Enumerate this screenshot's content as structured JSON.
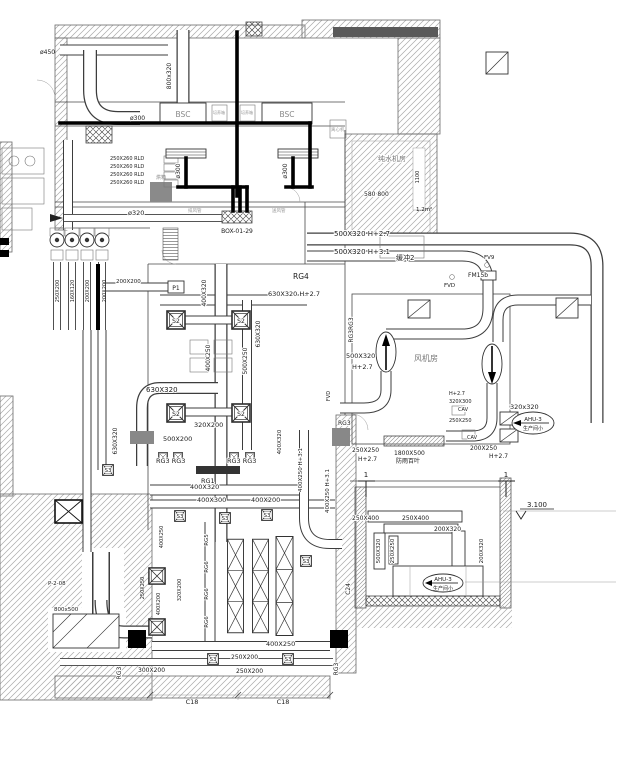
{
  "colors": {
    "background": "#ffffff",
    "line": "#3d3d3d",
    "pipe": "#000000",
    "hatch": "#a8a8a8"
  },
  "sizes": {
    "s450": "ø450",
    "s800x320": "800x320",
    "s300": "ø300",
    "s320": "ø320",
    "s250x260": "250X260 RLD",
    "s500x320h27": "500X320 H+2.7",
    "s500x320h31": "500X320 H+3.1",
    "s630x320h27": "630X320 H+2.7",
    "s630x320": "630X320",
    "s500x320": "500X320",
    "s500x250": "500X250",
    "s400x320": "400X320",
    "s400x250": "400X250",
    "s400x250h31": "400X250 H+3.1",
    "s320x200": "320X200",
    "s500x200": "500X200",
    "s400x300": "400X300",
    "s400x200": "400X200",
    "s300x200": "300X200",
    "s250x250": "250X250",
    "s250x200": "250X200",
    "s160x120": "160X120",
    "s200x200": "200X200",
    "s200x250": "200X250",
    "s320x300": "320X300",
    "s320x320": "320x320",
    "s250x400": "250X400",
    "s200x320": "200X320",
    "s1800x500": "1800X500",
    "s800x500": "800x500",
    "s580800": "580 800",
    "s1100": "1100",
    "s12m2": "1.2m²",
    "h27": "H+2.7"
  },
  "tags": {
    "rg1": "RG1",
    "rg3": "RG3",
    "rg3rg3": "RG3 RG3",
    "rg3rg3v": "RG3RG3",
    "rg4": "RG4",
    "rg5": "RG5",
    "rg6": "RG6",
    "s2": "S2",
    "s3": "S3",
    "p1": "P1",
    "fv9": "FV9",
    "fvd": "FVD",
    "fm15b": "FM15b",
    "cav": "CAV",
    "ahu3": "AHU-3",
    "ahu3sub": "生产间小",
    "box": "BOX-01-29",
    "p208": "P-2-08"
  },
  "rooms": {
    "bsc": "BSC",
    "fjf": "风机房",
    "csjf": "纯水机房",
    "hc2": "缓冲2",
    "fyby": "防雨百叶",
    "pyx": "培养箱",
    "lxj": "离心机",
    "hx": "烘箱"
  },
  "annos": {
    "pfg": "排风管",
    "sfg": "送风管"
  },
  "dims": {
    "c18": "C18",
    "c24": "C24",
    "lvl": "3.100",
    "sec1": "1"
  }
}
